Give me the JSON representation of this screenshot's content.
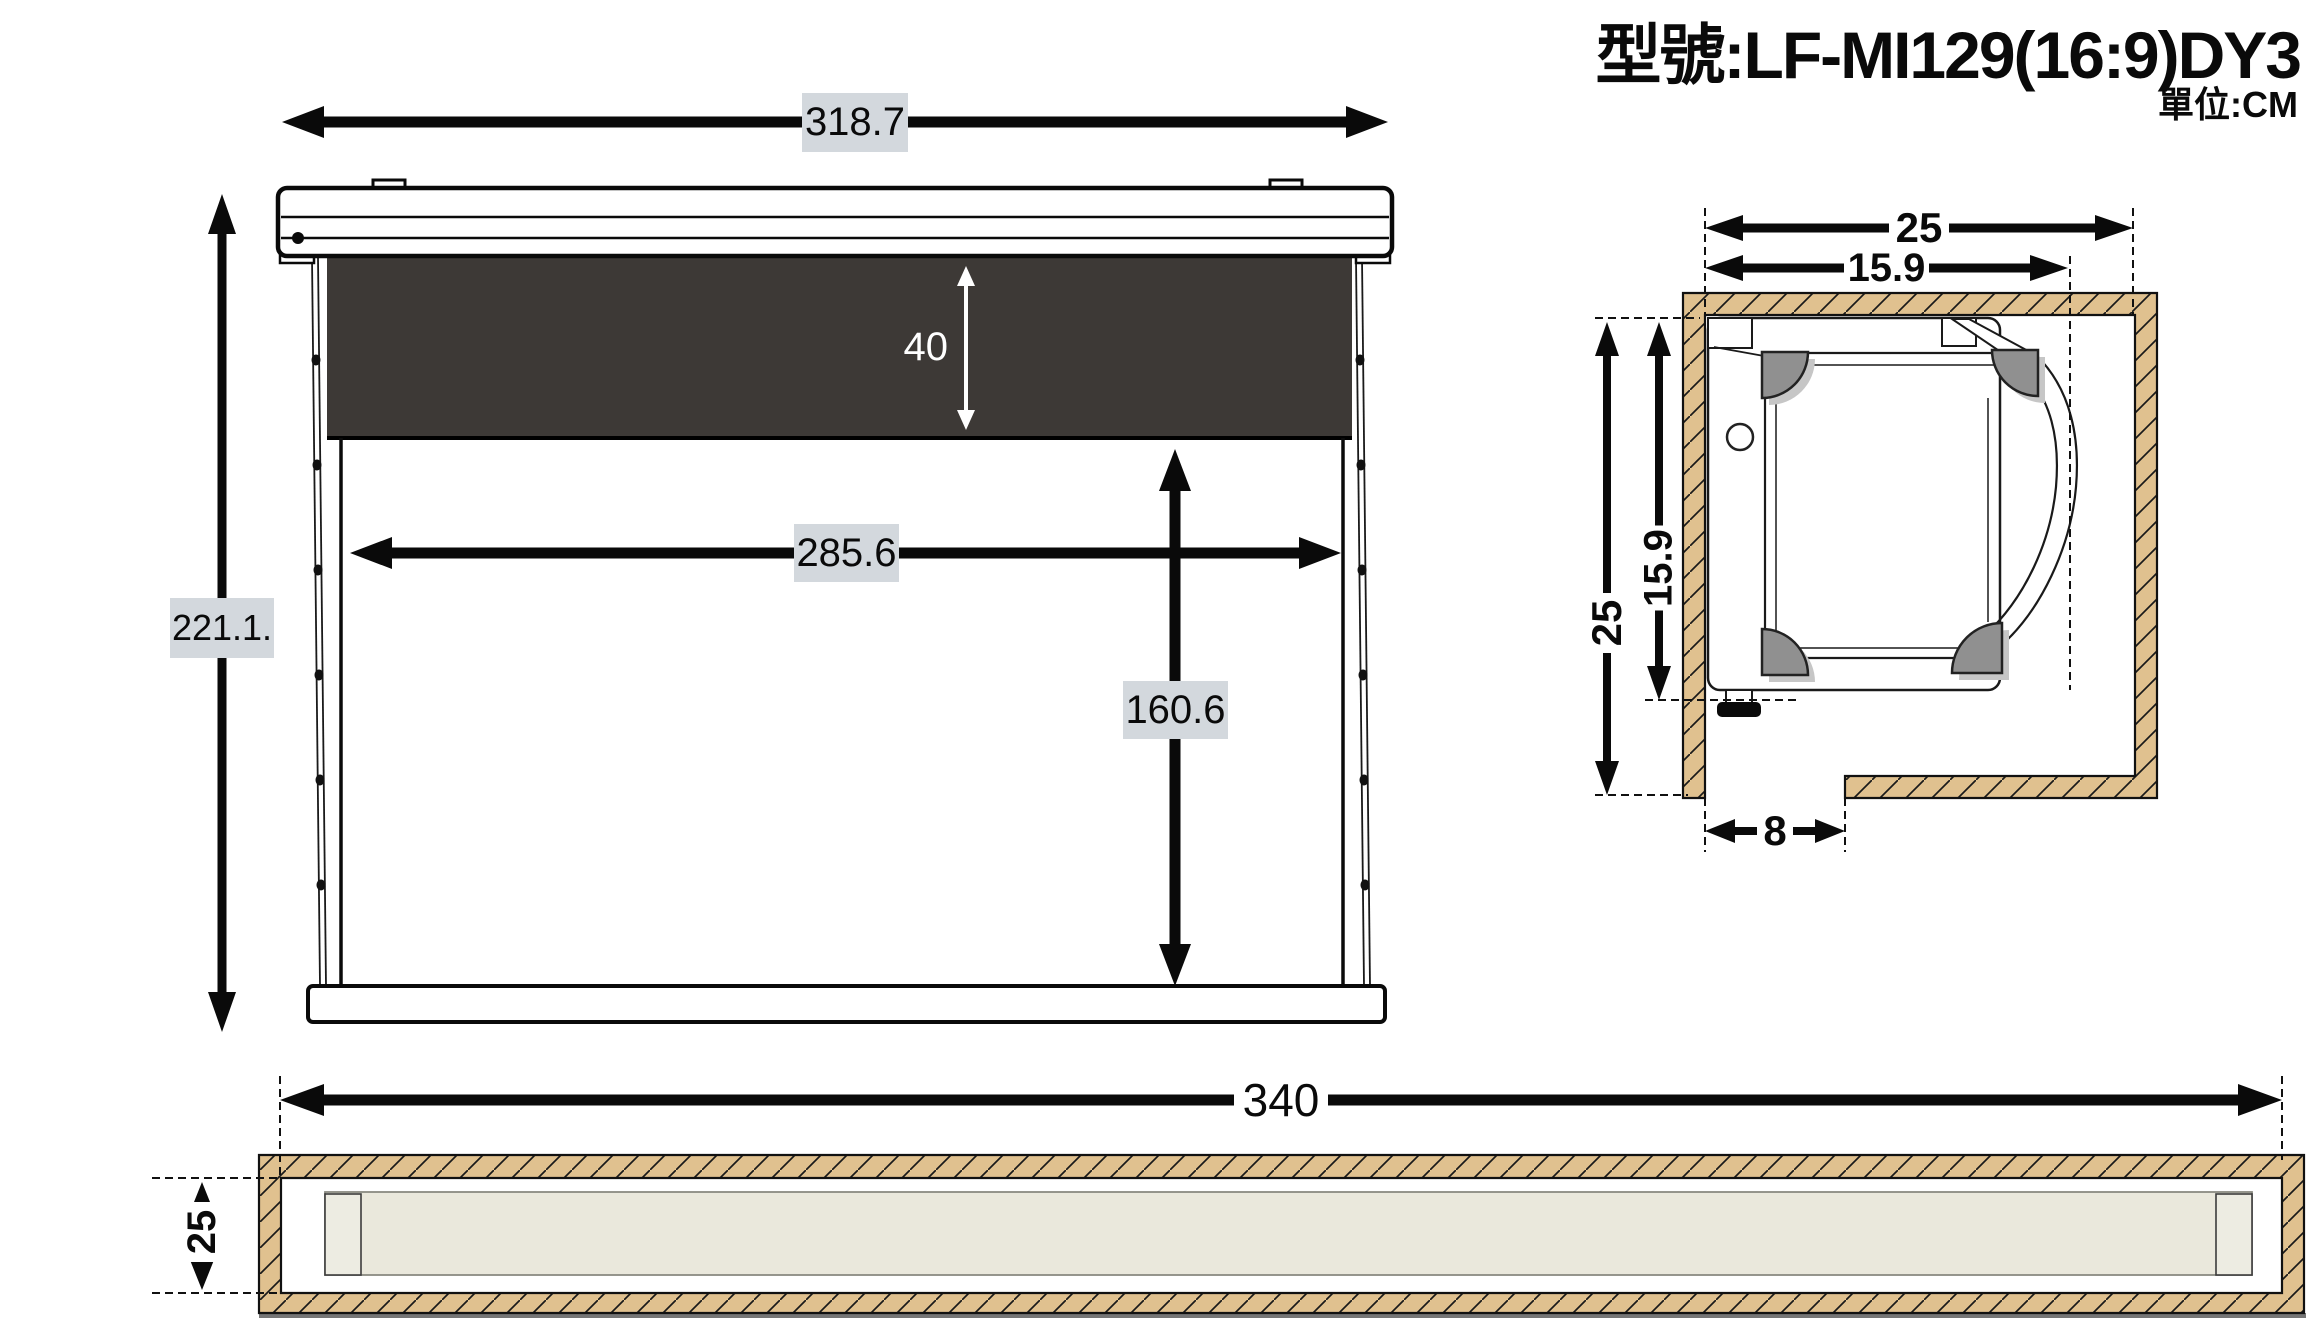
{
  "meta": {
    "model_title": "型號:LF-MI129(16:9)DY3",
    "unit_label": "單位:CM"
  },
  "front_view": {
    "total_width": "318.7",
    "total_height": "221.1.",
    "black_drop_height": "40",
    "viewing_width": "285.6",
    "viewing_height": "160.6"
  },
  "side_section": {
    "recess_inner_width": "25",
    "case_depth_width": "15.9",
    "recess_inner_height": "25",
    "case_depth_height": "15.9",
    "wall_clearance": "8"
  },
  "bottom_view": {
    "total_length": "340",
    "recess_depth": "25"
  },
  "colors": {
    "dimension_label_background": "#d3d8dd",
    "black_drop": "#3d3936",
    "wood_wall": "#e0c18f",
    "casing_beige": "#eae8dc",
    "shadow_strip": "#757575",
    "pulley_gray": "#909090"
  }
}
